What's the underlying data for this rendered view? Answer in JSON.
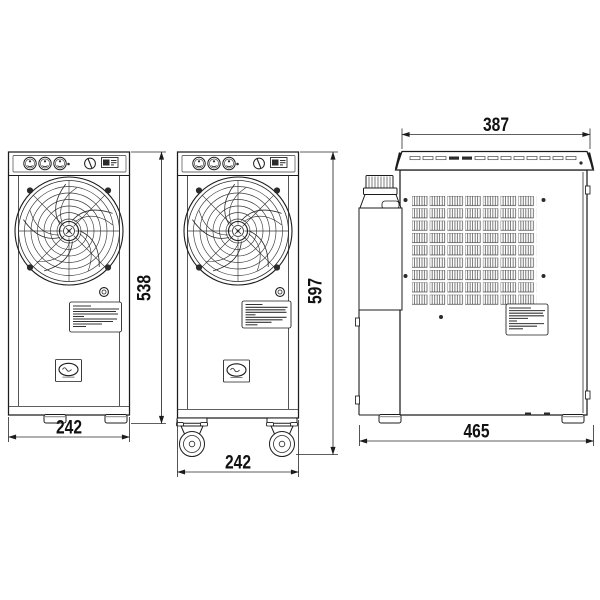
{
  "dimensions": {
    "front_width": "242",
    "front_height": "538",
    "caster_front_width": "242",
    "caster_front_height": "597",
    "side_top_width": "387",
    "side_bottom_width": "465"
  },
  "colors": {
    "line": "#1c1c1c",
    "background": "#ffffff",
    "screw": "#2b2b2b"
  }
}
